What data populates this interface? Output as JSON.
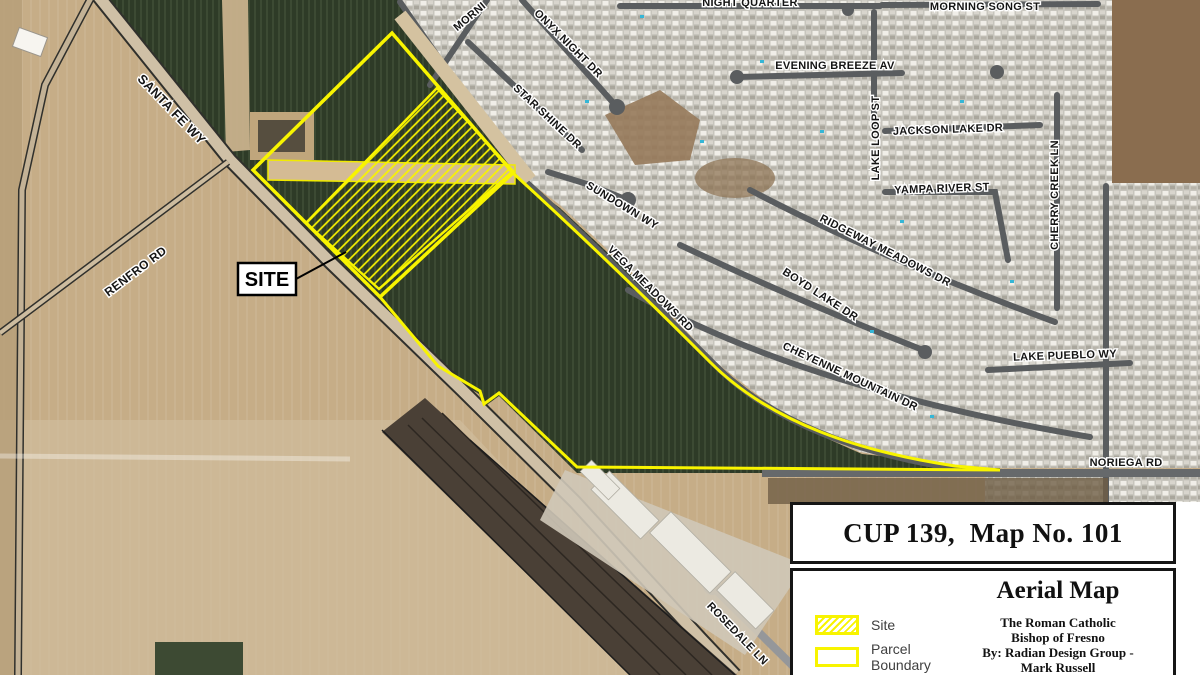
{
  "map": {
    "site_callout": {
      "label": "SITE"
    },
    "street_labels": [
      {
        "text": "SANTA FE WY",
        "x": 171,
        "y": 110,
        "rot": 46,
        "size": 13
      },
      {
        "text": "RENFRO RD",
        "x": 136,
        "y": 272,
        "rot": -37,
        "size": 12
      },
      {
        "text": "MORNI",
        "x": 470,
        "y": 17,
        "rot": -40,
        "size": 11
      },
      {
        "text": "ONYX NIGHT DR",
        "x": 568,
        "y": 44,
        "rot": 45,
        "size": 11
      },
      {
        "text": "STAR SHINE DR",
        "x": 547,
        "y": 117,
        "rot": 43,
        "size": 11
      },
      {
        "text": "SUNDOWN WY",
        "x": 622,
        "y": 206,
        "rot": 31,
        "size": 11
      },
      {
        "text": "VEGA MEADOWS RD",
        "x": 650,
        "y": 289,
        "rot": 45,
        "size": 11
      },
      {
        "text": "NIGHT QUARTER",
        "x": 750,
        "y": 3,
        "rot": 0,
        "size": 11
      },
      {
        "text": "EVENING BREEZE AV",
        "x": 835,
        "y": 66,
        "rot": 0,
        "size": 11
      },
      {
        "text": "MORNING SONG ST",
        "x": 985,
        "y": 7,
        "rot": 0,
        "size": 11
      },
      {
        "text": "LAKE LOOP ST",
        "x": 876,
        "y": 138,
        "rot": -90,
        "size": 11
      },
      {
        "text": "JACKSON LAKE DR",
        "x": 948,
        "y": 130,
        "rot": -2,
        "size": 11
      },
      {
        "text": "YAMPA RIVER ST",
        "x": 942,
        "y": 189,
        "rot": -2,
        "size": 11
      },
      {
        "text": "CHERRY CREEK LN",
        "x": 1055,
        "y": 195,
        "rot": -90,
        "size": 11
      },
      {
        "text": "RIDGEWAY MEADOWS DR",
        "x": 885,
        "y": 251,
        "rot": 27,
        "size": 11
      },
      {
        "text": "BOYD LAKE DR",
        "x": 820,
        "y": 295,
        "rot": 33,
        "size": 11
      },
      {
        "text": "CHEYENNE MOUNTAIN DR",
        "x": 850,
        "y": 377,
        "rot": 25,
        "size": 11
      },
      {
        "text": "LAKE PUEBLO WY",
        "x": 1065,
        "y": 356,
        "rot": -2,
        "size": 11
      },
      {
        "text": "NORIEGA RD",
        "x": 1126,
        "y": 463,
        "rot": 0,
        "size": 11
      },
      {
        "text": "ROSEDALE LN",
        "x": 737,
        "y": 634,
        "rot": 46,
        "size": 11
      }
    ],
    "colors": {
      "boundary_yellow": "#f8f400",
      "field_green": "#2e3b27",
      "farmland_tan": "#c6ad87",
      "subdivision_gray": "#c7c5bd",
      "street_gray": "#5a5d5f"
    }
  },
  "title_block": {
    "map_title": "CUP 139,  Map No. 101",
    "map_type": "Aerial Map",
    "client_lines": [
      "The Roman Catholic",
      "Bishop of Fresno",
      "By: Radian Design Group -",
      "Mark Russell"
    ],
    "legend": {
      "items": [
        {
          "label": "Site"
        },
        {
          "label": "Parcel Boundary"
        }
      ]
    }
  }
}
